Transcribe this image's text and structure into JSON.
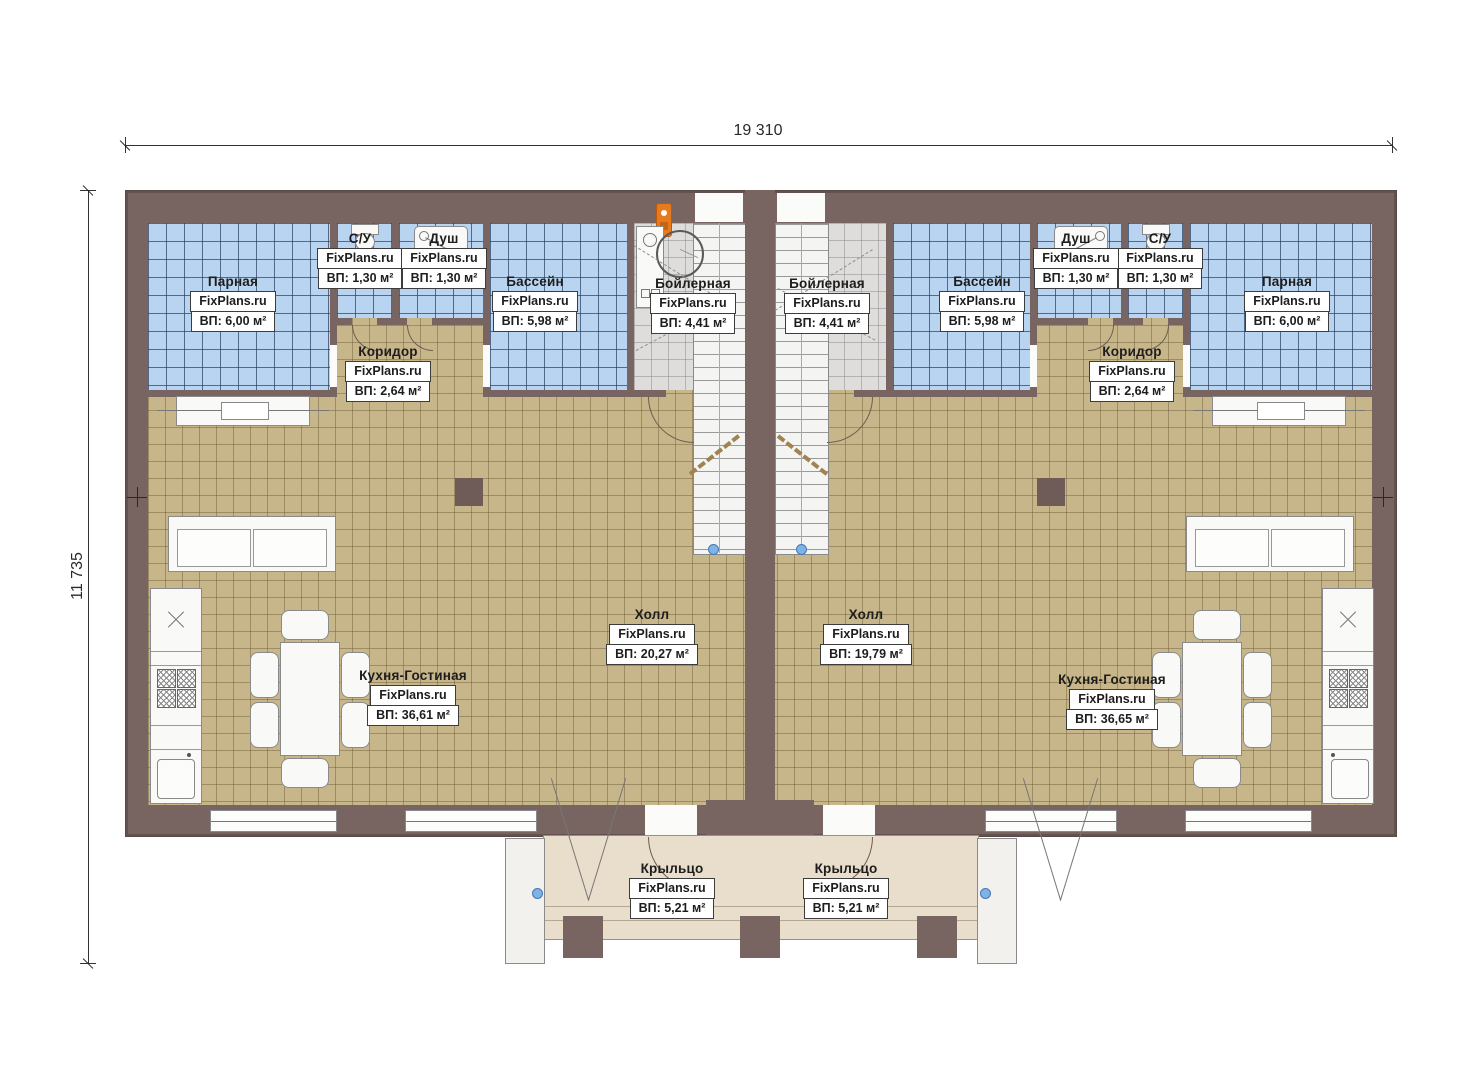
{
  "title": "Floor plan of a mirrored duplex house (FixPlans.ru)",
  "watermark": "FixPlans.ru",
  "dimensions": {
    "width_label": "19 310",
    "height_label": "11 735"
  },
  "colors": {
    "wall": "#786461",
    "tile_blue": "#b9d4f0",
    "tile_tan": "#c8b68b",
    "tile_gray": "#dedddb",
    "porch": "#e9decb",
    "accent_orange": "#e87a1e",
    "stair_dot_blue": "#7fb2e5"
  },
  "rooms": [
    {
      "id": "parnaya-left",
      "name": "Парная",
      "area": "ВП: 6,00 м²"
    },
    {
      "id": "su-left",
      "name": "С/У",
      "area": "ВП: 1,30 м²"
    },
    {
      "id": "dush-left",
      "name": "Душ",
      "area": "ВП: 1,30 м²"
    },
    {
      "id": "bassein-left",
      "name": "Бассейн",
      "area": "ВП: 5,98 м²"
    },
    {
      "id": "boilernaya-left",
      "name": "Бойлерная",
      "area": "ВП: 4,41 м²"
    },
    {
      "id": "koridor-left",
      "name": "Коридор",
      "area": "ВП: 2,64 м²"
    },
    {
      "id": "holl-left",
      "name": "Холл",
      "area": "ВП: 20,27 м²"
    },
    {
      "id": "kuhnya-left",
      "name": "Кухня-Гостиная",
      "area": "ВП: 36,61 м²"
    },
    {
      "id": "kryltso-left",
      "name": "Крыльцо",
      "area": "ВП: 5,21 м²"
    },
    {
      "id": "parnaya-right",
      "name": "Парная",
      "area": "ВП: 6,00 м²"
    },
    {
      "id": "su-right",
      "name": "С/У",
      "area": "ВП: 1,30 м²"
    },
    {
      "id": "dush-right",
      "name": "Душ",
      "area": "ВП: 1,30 м²"
    },
    {
      "id": "bassein-right",
      "name": "Бассейн",
      "area": "ВП: 5,98 м²"
    },
    {
      "id": "boilernaya-right",
      "name": "Бойлерная",
      "area": "ВП: 4,41 м²"
    },
    {
      "id": "koridor-right",
      "name": "Коридор",
      "area": "ВП: 2,64 м²"
    },
    {
      "id": "holl-right",
      "name": "Холл",
      "area": "ВП: 19,79 м²"
    },
    {
      "id": "kuhnya-right",
      "name": "Кухня-Гостиная",
      "area": "ВП: 36,65 м²"
    },
    {
      "id": "kryltso-right",
      "name": "Крыльцо",
      "area": "ВП: 5,21 м²"
    }
  ]
}
